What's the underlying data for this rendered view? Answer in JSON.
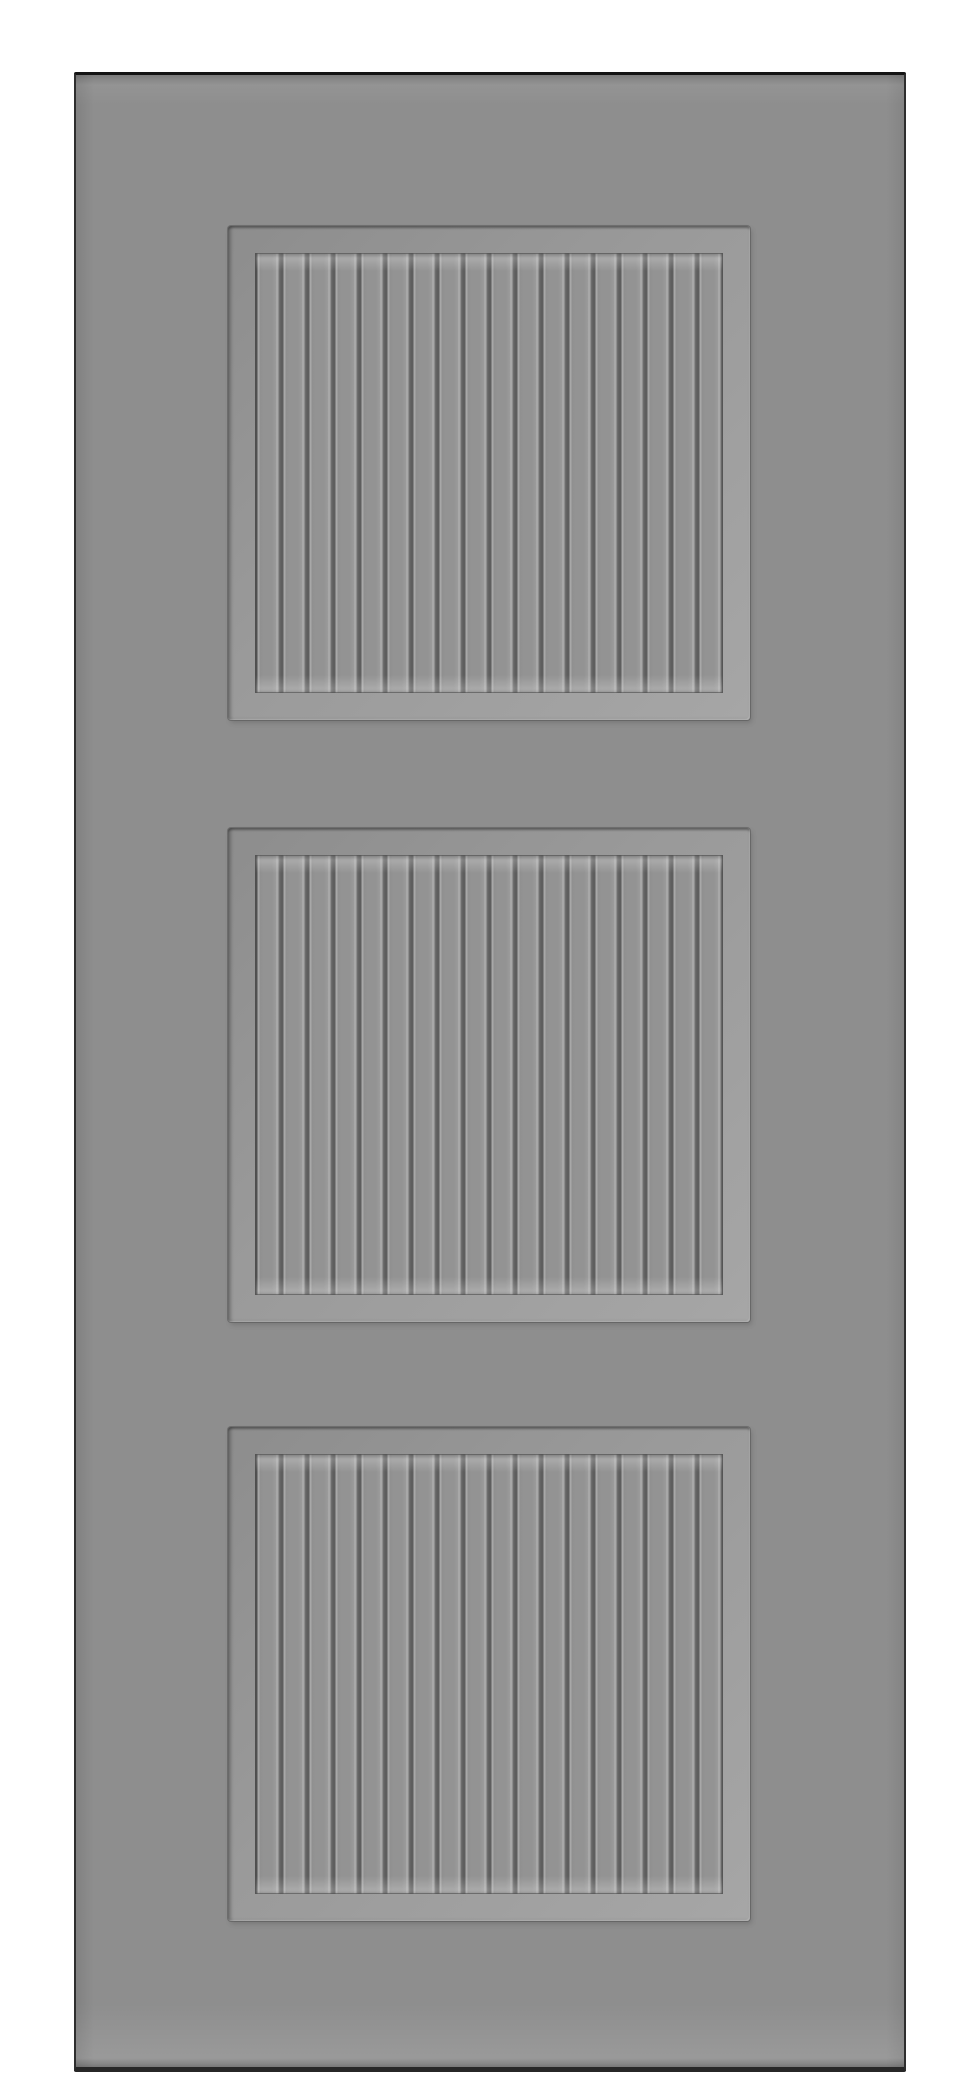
{
  "scene": {
    "subject": "Three-panel beadboard door slab, front elevation",
    "background_color": "#ffffff"
  },
  "door": {
    "face_color": "#8e8e8e",
    "edge_color": "#262626",
    "bevel_light_color": "#a6a6a6",
    "bevel_dark_color": "#787878",
    "groove_color": "#5e5e5e",
    "board_face_color": "#939393",
    "board_highlight_color": "#a8a8a8",
    "panel_count": 3,
    "boards_per_panel": 18,
    "panels": [
      {
        "id": "top-panel"
      },
      {
        "id": "middle-panel"
      },
      {
        "id": "bottom-panel"
      }
    ]
  }
}
